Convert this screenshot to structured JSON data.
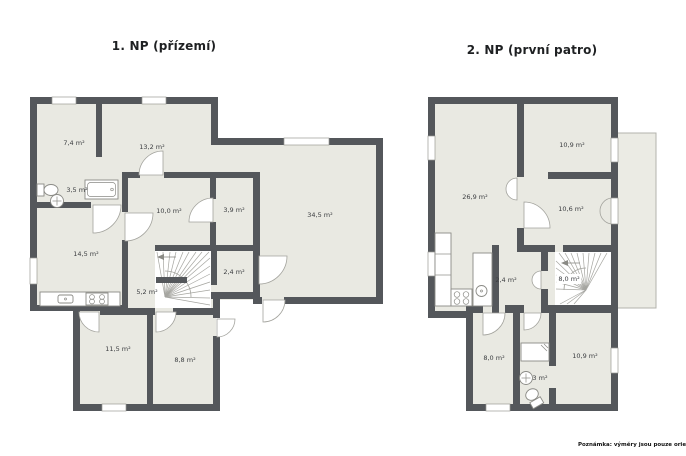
{
  "floor1": {
    "title": "1. NP (přízemí)",
    "rooms": [
      {
        "label": "7,4 m²"
      },
      {
        "label": "13,2 m²"
      },
      {
        "label": "3,5 m²"
      },
      {
        "label": "10,0 m²"
      },
      {
        "label": "3,9 m²"
      },
      {
        "label": "34,5 m²"
      },
      {
        "label": "14,5 m²"
      },
      {
        "label": "2,4 m²"
      },
      {
        "label": "5,2 m²"
      },
      {
        "label": "11,5 m²"
      },
      {
        "label": "8,8 m²"
      }
    ],
    "fixtures": [
      "toilet",
      "wash-basin",
      "bathtub",
      "kitchen-counter",
      "kitchen-sink",
      "stove",
      "winder-staircase",
      "stair-direction-arrow"
    ]
  },
  "floor2": {
    "title": "2. NP (první patro)",
    "rooms": [
      {
        "label": "26,9 m²"
      },
      {
        "label": "10,9 m²"
      },
      {
        "label": "10,6 m²"
      },
      {
        "label": "2,4 m²"
      },
      {
        "label": "8,0 m²"
      },
      {
        "label": "8,0 m²"
      },
      {
        "label": "10,9 m²"
      },
      {
        "label": "3 m²"
      }
    ],
    "fixtures": [
      "kitchen-counter",
      "kitchen-sink",
      "stove",
      "shower",
      "wash-basin",
      "toilet",
      "winder-staircase",
      "stair-direction-arrow",
      "balcony"
    ]
  },
  "note": "Poznámka: výměry jsou pouze orientační.",
  "colors": {
    "wall": "#54575b",
    "room": "#e9e9e2",
    "balcony": "#ebebe4"
  }
}
